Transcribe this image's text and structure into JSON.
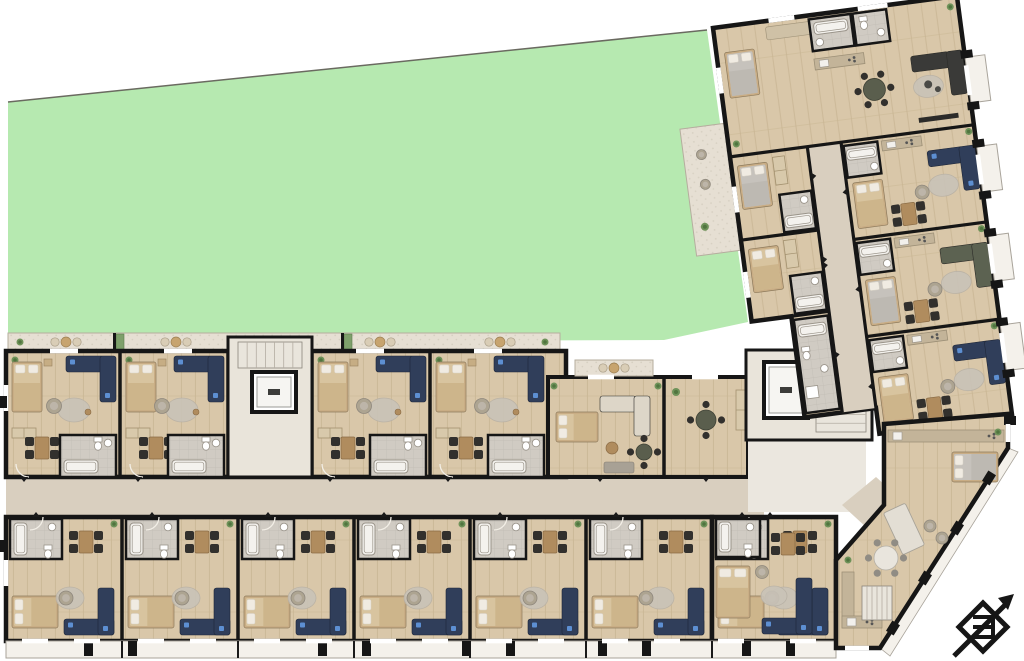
{
  "meta": {
    "title": "apartment-building-floor-plan"
  },
  "canvas": {
    "w": 1024,
    "h": 661,
    "background": "#ffffff"
  },
  "palette": {
    "wall": "#161616",
    "lawn": "#b6e9b0",
    "propertyLine": "#6a6a60",
    "wood": "#d9c7a9",
    "woodLine": "#c8b492",
    "bath": "#d0cbc3",
    "bathGrid": "#c1bcb4",
    "corridor": "#d9cfbf",
    "lobby": "#ebe7df",
    "coreBg": "#e9e4da",
    "stone": "#e6dfd3",
    "stoneDot": "#d7d0c2",
    "balcony": "#f4f1eb",
    "balconyLine": "#a8a39a",
    "sofaNavy": "#303e5a",
    "sofaOlive": "#5c6251",
    "sofaDark": "#3a3a38",
    "sofaLight": "#ddd6c8",
    "accentBlue": "#5d8fd2",
    "armchair": "#ada491",
    "rug": "#c9c3b8",
    "chair": "#32302d",
    "tableWood": "#b08c5e",
    "bedFrame": "#c9ad85",
    "bedSheet": "#d8c49f",
    "bedBlanket": "#cdb58b",
    "bedGray": "#c6c2bc",
    "pillow": "#f0ebe2",
    "fixture": "#f4f2ee",
    "fixtureLine": "#9a948a",
    "counter": "#c3b499",
    "plant": "#6e9259",
    "plantDark": "#50753f",
    "arc": "#f3efe7",
    "window": "#ffffff"
  },
  "lawn": {
    "points": "8,102 707,30 748,322 664,340 8,342",
    "propertyLine": "8,102 707,30"
  },
  "leftWing": {
    "terrace": {
      "x": 8,
      "y": 333,
      "w": 552,
      "h": 18,
      "sets": [
        66,
        176,
        380,
        500
      ],
      "planters": [
        116,
        344
      ]
    },
    "topBlock": {
      "x": 6,
      "y": 351,
      "w": 560,
      "h": 126
    },
    "corridor": {
      "x": 6,
      "y": 477,
      "w": 758,
      "h": 40
    },
    "bottomBlock": {
      "x": 6,
      "y": 517,
      "w": 706,
      "h": 124
    },
    "lowerJunction": {
      "x": 712,
      "y": 517,
      "w": 124,
      "h": 124
    },
    "junctionA": {
      "x": 548,
      "y": 377,
      "w": 200,
      "h": 100,
      "partition": 664,
      "terrace": {
        "x": 575,
        "y": 360,
        "w": 78,
        "h": 16
      }
    },
    "core": {
      "x": 228,
      "y": 337,
      "w": 84,
      "h": 140,
      "elevator": {
        "x": 252,
        "y": 372,
        "w": 44,
        "h": 40
      },
      "stairs": {
        "x": 238,
        "y": 342,
        "w": 64,
        "h": 26
      }
    },
    "partitionsTop": [
      120,
      228,
      312,
      430
    ],
    "partitionsBottom": [
      122,
      238,
      354,
      470,
      586
    ],
    "topUnits": [
      {
        "x": 6,
        "w": 114
      },
      {
        "x": 120,
        "w": 108
      },
      {
        "x": 312,
        "w": 118
      },
      {
        "x": 430,
        "w": 118
      }
    ],
    "bottomUnits": [
      {
        "x": 6,
        "w": 116
      },
      {
        "x": 122,
        "w": 116
      },
      {
        "x": 238,
        "w": 116
      },
      {
        "x": 354,
        "w": 116
      },
      {
        "x": 470,
        "w": 116
      },
      {
        "x": 586,
        "w": 126
      },
      {
        "x": 712,
        "w": 124
      }
    ],
    "balconyStrip": {
      "x": 6,
      "y": 641,
      "w": 830,
      "h": 17,
      "piers": [
        84,
        128,
        318,
        362,
        462,
        506,
        598,
        642,
        742,
        786
      ],
      "dividers": [
        122,
        238,
        354,
        470,
        586,
        712
      ]
    },
    "windowsTop": [
      50,
      164,
      356,
      474
    ],
    "windowsBottomPairs": [
      22,
      74,
      138,
      190,
      254,
      306,
      370,
      422,
      486,
      538,
      602,
      654,
      718,
      790
    ],
    "windowsLeft": [
      385,
      560
    ],
    "windowsJunctionTop": [
      588,
      692
    ]
  },
  "rightWing": {
    "pivot": {
      "x": 713,
      "y": 28
    },
    "angle": -7.5,
    "bodyPoints": "0,0 246,0 246,424 112,424 112,398 40,398 40,296 0,296",
    "corridor": {
      "x": 78,
      "y": 130,
      "w": 34,
      "h": 268
    },
    "hWalls": [
      [
        0,
        130,
        246
      ],
      [
        0,
        214,
        78
      ],
      [
        112,
        228,
        246
      ],
      [
        0,
        296,
        78
      ],
      [
        112,
        326,
        246
      ]
    ],
    "vWalls": [
      [
        78,
        130,
        398
      ],
      [
        112,
        130,
        424
      ],
      [
        40,
        296,
        398
      ]
    ],
    "leftRooms": [
      {
        "y": 130,
        "h": 84
      },
      {
        "y": 214,
        "h": 82
      }
    ],
    "rightApts": [
      130,
      228,
      326
    ],
    "utilityCol": {
      "x": 42,
      "y": 300,
      "w": 34,
      "h": 94
    },
    "terrace": {
      "x": -46,
      "y": 96,
      "w": 46,
      "h": 128
    },
    "balconies": [
      62,
      152,
      242,
      332
    ],
    "windows": [
      {
        "x": 56,
        "y": 0,
        "len": 26,
        "o": "h"
      },
      {
        "x": 146,
        "y": 0,
        "len": 30,
        "o": "h"
      },
      {
        "x": 246,
        "y": 70,
        "len": 30,
        "o": "v"
      },
      {
        "x": 246,
        "y": 160,
        "len": 30,
        "o": "v"
      },
      {
        "x": 246,
        "y": 250,
        "len": 30,
        "o": "v"
      },
      {
        "x": 246,
        "y": 340,
        "len": 30,
        "o": "v"
      },
      {
        "x": 0,
        "y": 40,
        "len": 26,
        "o": "v"
      },
      {
        "x": 0,
        "y": 160,
        "len": 26,
        "o": "v"
      },
      {
        "x": 0,
        "y": 246,
        "len": 26,
        "o": "v"
      }
    ]
  },
  "junction": {
    "lobby": {
      "x": 748,
      "y": 438,
      "w": 118,
      "h": 74
    },
    "diag": "842,505 876,477 952,545 916,573",
    "core": {
      "x": 746,
      "y": 350,
      "w": 126,
      "h": 90,
      "elevator": {
        "x": 764,
        "y": 362,
        "w": 44,
        "h": 56
      },
      "stairs": {
        "x": 816,
        "y": 362,
        "w": 50,
        "h": 70
      }
    }
  },
  "cornerApartment": {
    "points": "884,424 1008,414 1008,448 880,648 836,648 836,560 884,505",
    "counter": {
      "x": 888,
      "y": 430,
      "w": 116,
      "h": 12
    },
    "bed": {
      "x": 952,
      "y": 452,
      "w": 46,
      "h": 30
    },
    "island": {
      "x": 892,
      "y": 506,
      "w": 24,
      "h": 46,
      "rot": -25
    },
    "diningRound": {
      "cx": 886,
      "cy": 558,
      "r": 12
    },
    "armchairs": [
      [
        930,
        526
      ],
      [
        942,
        538
      ]
    ],
    "kitchenL": [
      [
        842,
        572,
        12,
        56
      ],
      [
        842,
        616,
        40,
        12
      ]
    ],
    "stairs": {
      "x": 862,
      "y": 586,
      "w": 30,
      "h": 34
    },
    "plants": [
      [
        998,
        432
      ],
      [
        848,
        560
      ]
    ],
    "balconyDiag": "1008,448 1018,452 890,656 880,648",
    "diagPiers": [
      [
        989,
        478
      ],
      [
        957,
        528
      ],
      [
        925,
        578
      ],
      [
        893,
        628
      ]
    ],
    "rightPier": [
      1004,
      416
    ]
  },
  "compass": {
    "x": 950,
    "y": 592
  }
}
